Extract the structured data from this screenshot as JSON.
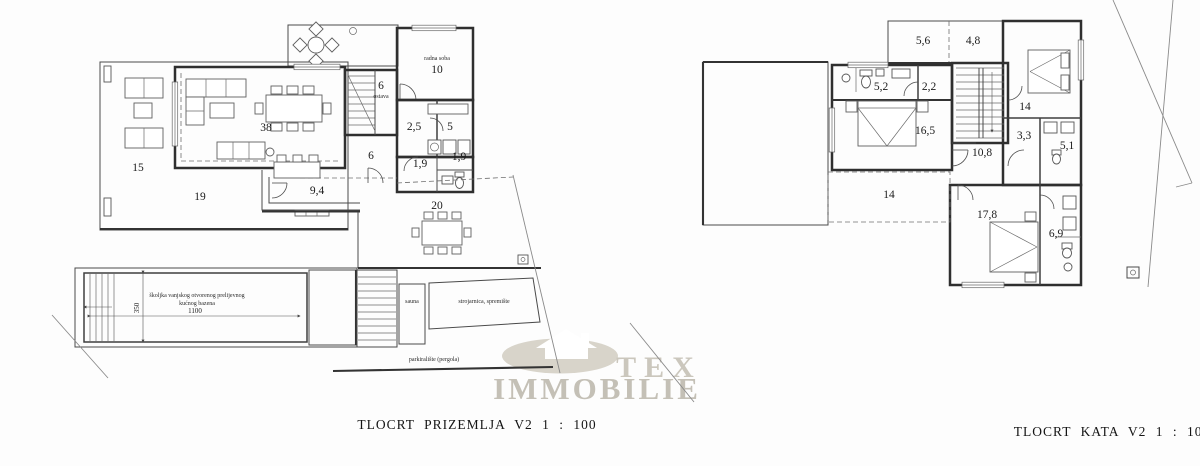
{
  "document": {
    "type": "architectural floor plan sheet",
    "background": "#fdfdfd",
    "line_color": "#3a3a3a"
  },
  "watermark": {
    "line1": "TEX",
    "line2": "IMMOBILIE",
    "logo": "house-in-ellipse",
    "color": "#cbc7bd"
  },
  "captions": {
    "ground": "TLOCRT PRIZEMLJA V2 1 : 100",
    "upper": "TLOCRT KATA V2 1 : 100"
  },
  "ground_floor": {
    "terrace_west": "15",
    "terrace_south": "19",
    "living_dining": "38",
    "stair_room": "6",
    "stair_room_note": "ostava",
    "study_note": "radna soba",
    "study": "10",
    "pantry": "2,5",
    "kitchen": "5",
    "hallway": "6",
    "wc_left": "1,9",
    "wc_right": "1,9",
    "porch": "9,4",
    "terrace_dining": "20",
    "pool_note_1": "školjka vanjskog otvorenog prelijevnog",
    "pool_note_2": "kućnog bazena",
    "pool_length": "1100",
    "pool_width": "350",
    "sauna": "sauna",
    "machine_room": "strojarnica, spremište",
    "parking": "parkiralište (pergola)"
  },
  "upper_floor": {
    "terrace_a": "5,6",
    "terrace_b": "4,8",
    "bath_master": "5,2",
    "closet": "2,2",
    "bedroom_west": "16,5",
    "bedroom_east": "14",
    "landing": "3,3",
    "hall": "10,8",
    "bath_east": "5,1",
    "roof_terrace": "14",
    "bedroom_south": "17,8",
    "bath_south": "6,9"
  }
}
